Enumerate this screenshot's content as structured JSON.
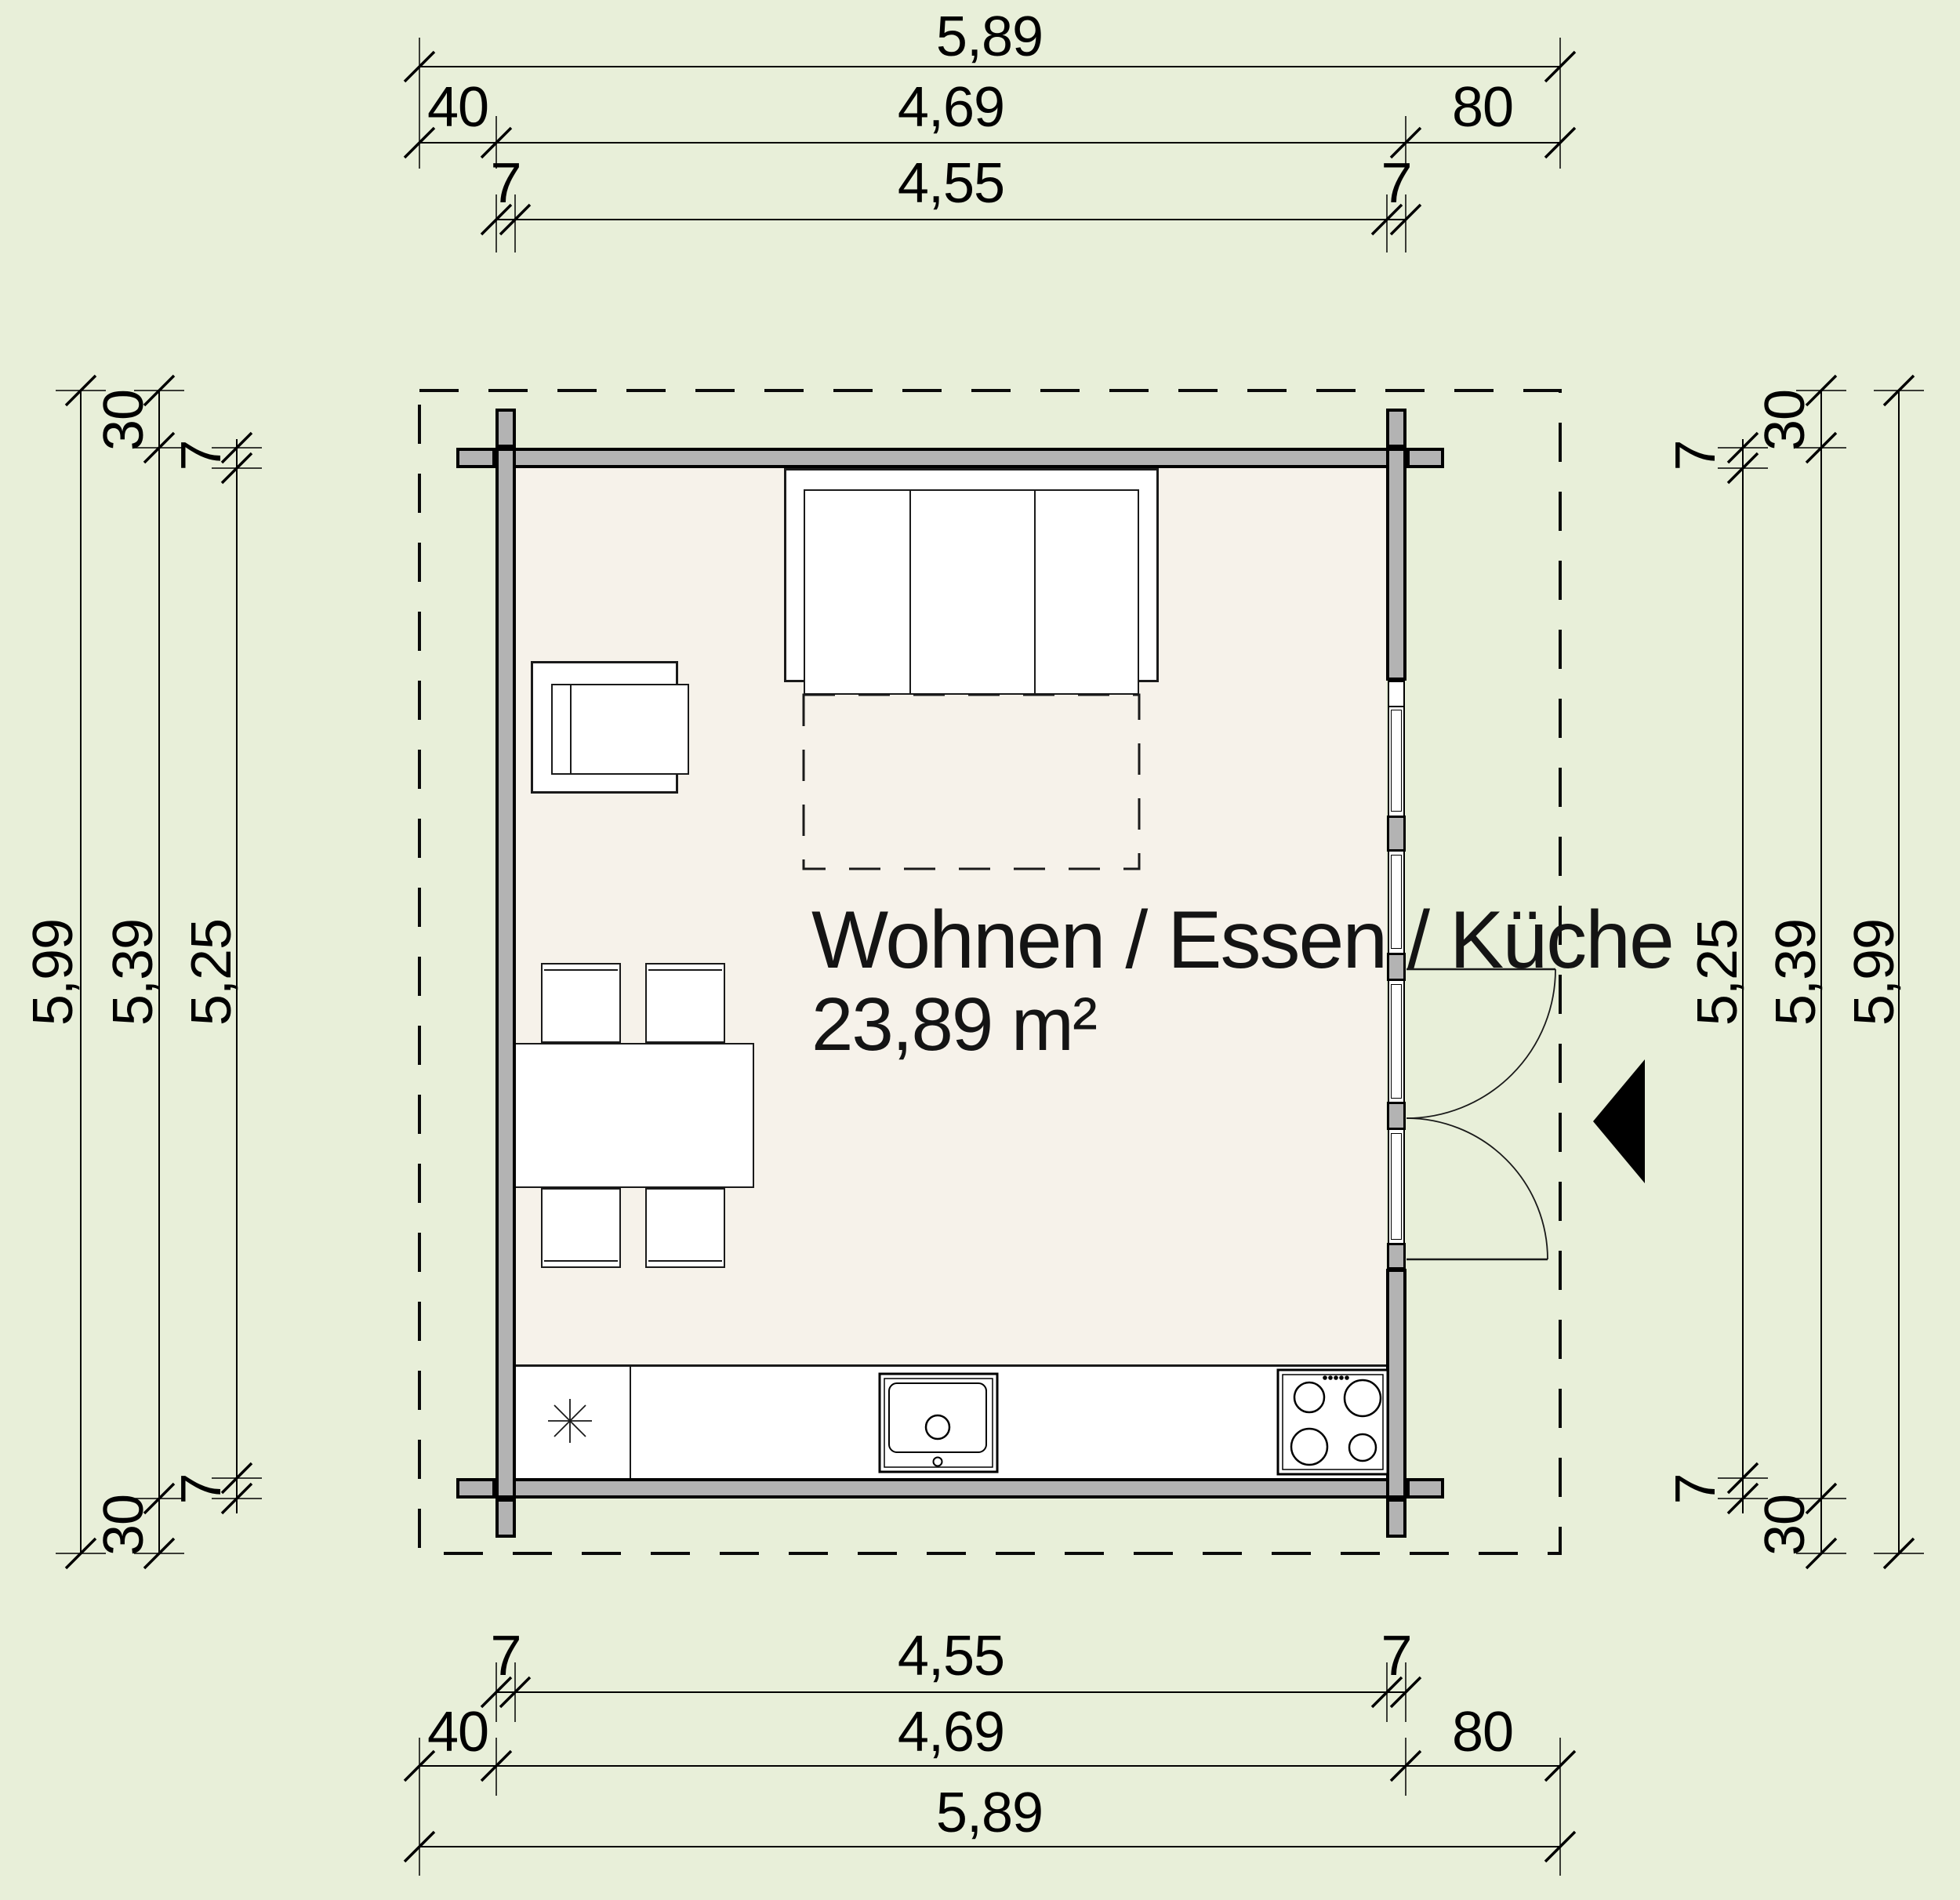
{
  "room": {
    "name": "Wohnen / Essen / Küche",
    "area": "23,89 m²"
  },
  "dims": {
    "top": {
      "total": "5,89",
      "left_overhang": "40",
      "outer": "4,69",
      "right_overhang": "80",
      "wall_l": "7",
      "inner": "4,55",
      "wall_r": "7"
    },
    "bottom": {
      "total": "5,89",
      "left_overhang": "40",
      "outer": "4,69",
      "right_overhang": "80",
      "wall_l": "7",
      "inner": "4,55",
      "wall_r": "7"
    },
    "left": {
      "total": "5,99",
      "outer": "5,39",
      "inner": "5,25",
      "overhang_top": "30",
      "wall_top": "7",
      "wall_bottom": "7",
      "overhang_bottom": "30"
    },
    "right": {
      "total": "5,99",
      "outer": "5,39",
      "inner": "5,25",
      "overhang_top": "30",
      "wall_top": "7",
      "wall_bottom": "7",
      "overhang_bottom": "30"
    }
  },
  "colors": {
    "background": "#e8efd9",
    "floor": "#f6f2ea",
    "wall": "#b3b3b3",
    "line": "#000000"
  }
}
